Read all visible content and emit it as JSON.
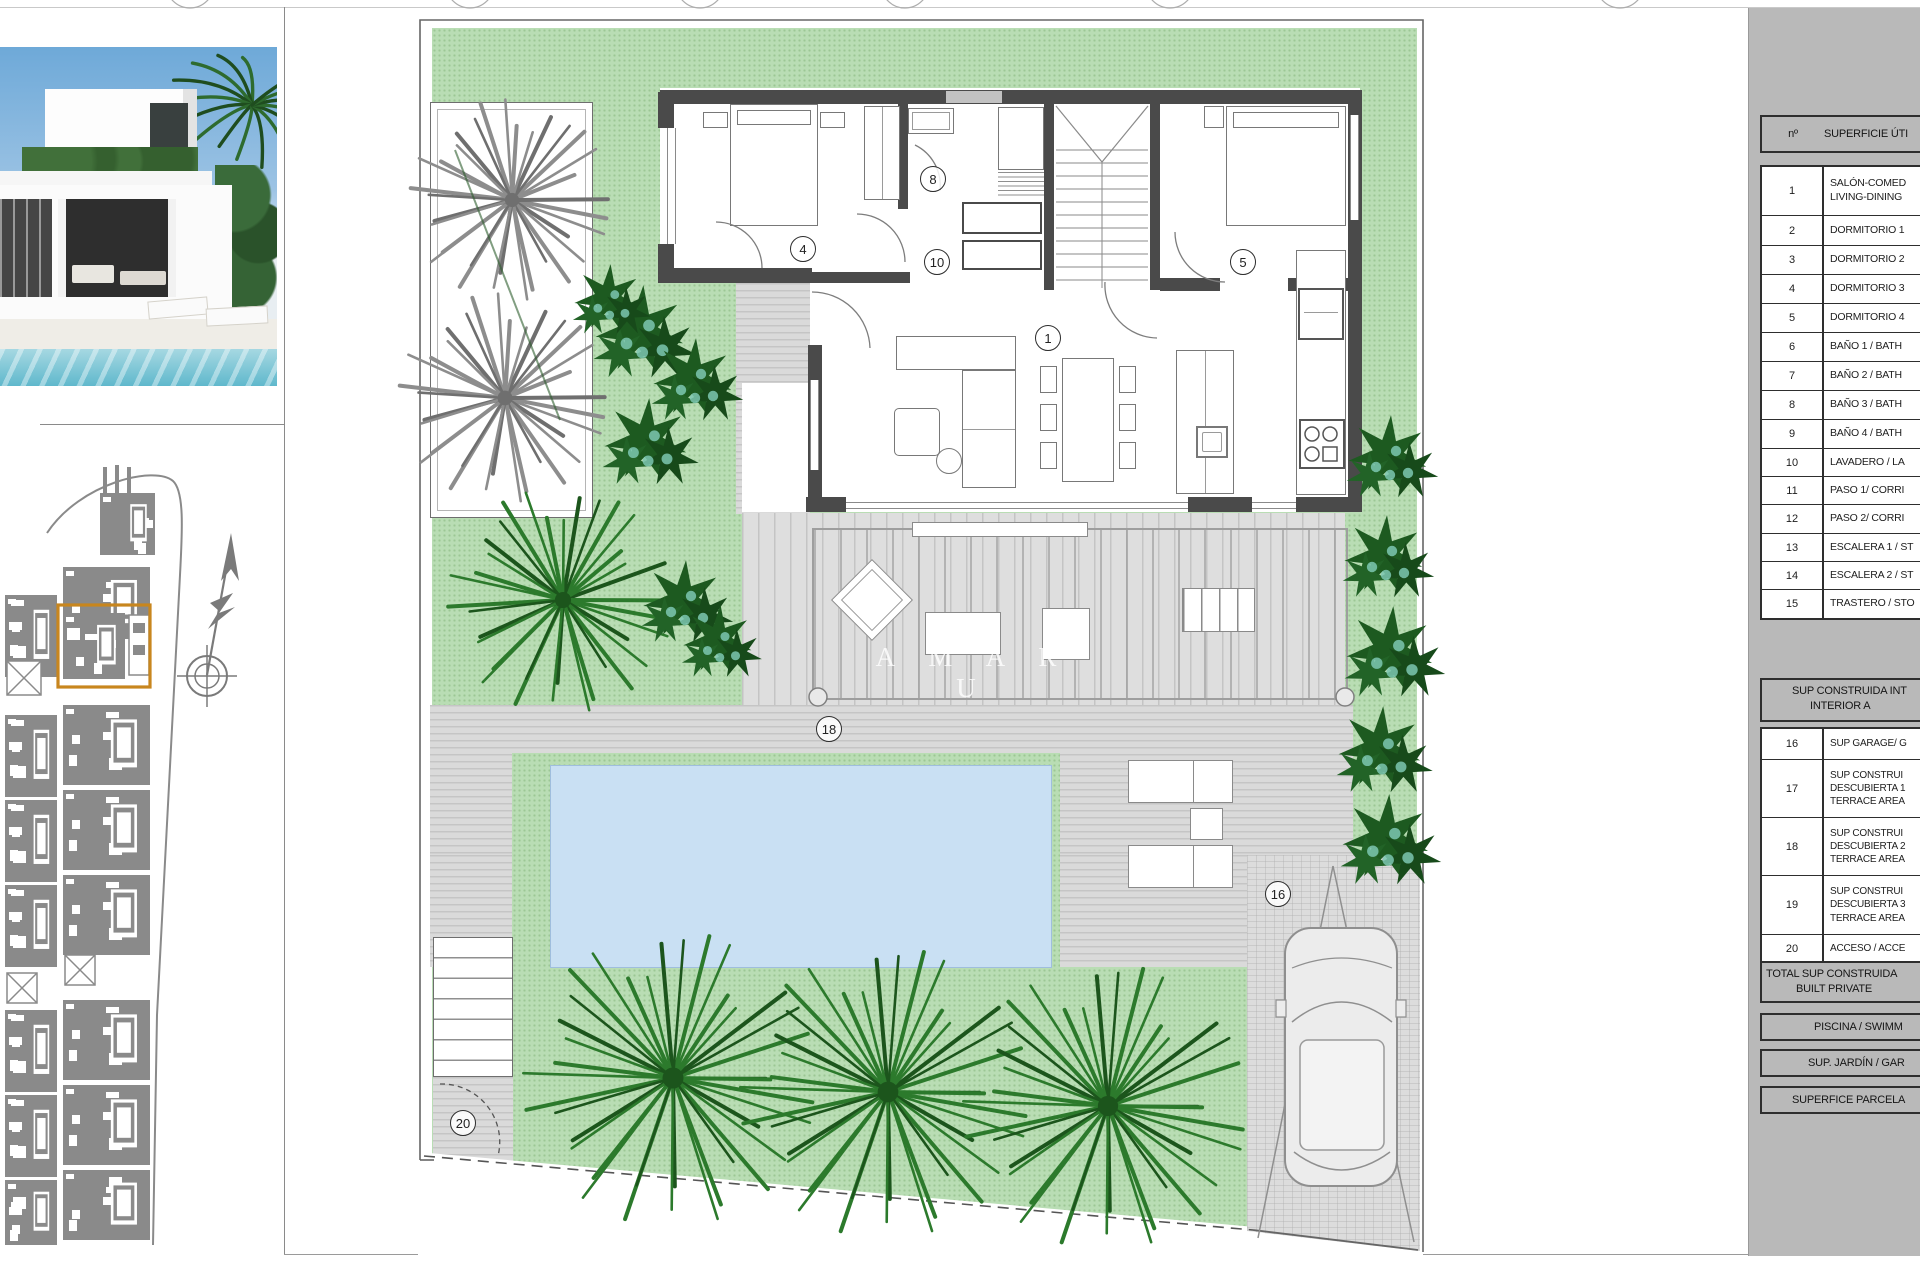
{
  "photo": {
    "name": "villa-exterior-render"
  },
  "plan": {
    "watermark": "AMARU",
    "labels": [
      {
        "n": "4",
        "x": 802,
        "y": 248
      },
      {
        "n": "8",
        "x": 932,
        "y": 178
      },
      {
        "n": "10",
        "x": 936,
        "y": 261
      },
      {
        "n": "5",
        "x": 1242,
        "y": 261
      },
      {
        "n": "1",
        "x": 1047,
        "y": 337
      },
      {
        "n": "18",
        "x": 828,
        "y": 728
      },
      {
        "n": "16",
        "x": 1277,
        "y": 893
      },
      {
        "n": "20",
        "x": 462,
        "y": 1122
      }
    ]
  },
  "sidebar_table": {
    "header": {
      "num_label": "nº",
      "title": "SUPERFICIE ÚTI"
    },
    "rows": [
      {
        "num": "1",
        "lines": [
          "SALÓN-COMED",
          "LIVING-DINING"
        ]
      },
      {
        "num": "2",
        "lines": [
          "DORMITORIO 1"
        ]
      },
      {
        "num": "3",
        "lines": [
          "DORMITORIO 2"
        ]
      },
      {
        "num": "4",
        "lines": [
          "DORMITORIO 3"
        ]
      },
      {
        "num": "5",
        "lines": [
          "DORMITORIO 4"
        ]
      },
      {
        "num": "6",
        "lines": [
          "BAÑO 1 / BATH"
        ]
      },
      {
        "num": "7",
        "lines": [
          "BAÑO 2 / BATH"
        ]
      },
      {
        "num": "8",
        "lines": [
          "BAÑO 3 / BATH"
        ]
      },
      {
        "num": "9",
        "lines": [
          "BAÑO 4 / BATH"
        ]
      },
      {
        "num": "10",
        "lines": [
          "LAVADERO / LA"
        ]
      },
      {
        "num": "11",
        "lines": [
          "PASO 1/ CORRI"
        ]
      },
      {
        "num": "12",
        "lines": [
          "PASO 2/ CORRI"
        ]
      },
      {
        "num": "13",
        "lines": [
          "ESCALERA 1 / ST"
        ]
      },
      {
        "num": "14",
        "lines": [
          "ESCALERA 2 / ST"
        ]
      },
      {
        "num": "15",
        "lines": [
          "TRASTERO / STO"
        ]
      }
    ],
    "section2_header": [
      "SUP CONSTRUIDA INT",
      "INTERIOR A"
    ],
    "rows2": [
      {
        "num": "16",
        "lines": [
          "SUP GARAGE/ G"
        ]
      },
      {
        "num": "17",
        "lines": [
          "SUP CONSTRUI",
          "DESCUBIERTA 1",
          "TERRACE AREA"
        ]
      },
      {
        "num": "18",
        "lines": [
          "SUP CONSTRUI",
          "DESCUBIERTA 2",
          "TERRACE AREA"
        ]
      },
      {
        "num": "19",
        "lines": [
          "SUP CONSTRUI",
          "DESCUBIERTA 3",
          "TERRACE AREA"
        ]
      },
      {
        "num": "20",
        "lines": [
          "ACCESO / ACCE"
        ]
      }
    ],
    "total_box": [
      "TOTAL SUP CONSTRUIDA",
      "BUILT PRIVATE"
    ],
    "footer_boxes": [
      "PISCINA / SWIMM",
      "SUP. JARDÍN / GAR",
      "SUPERFICE PARCELA"
    ]
  }
}
